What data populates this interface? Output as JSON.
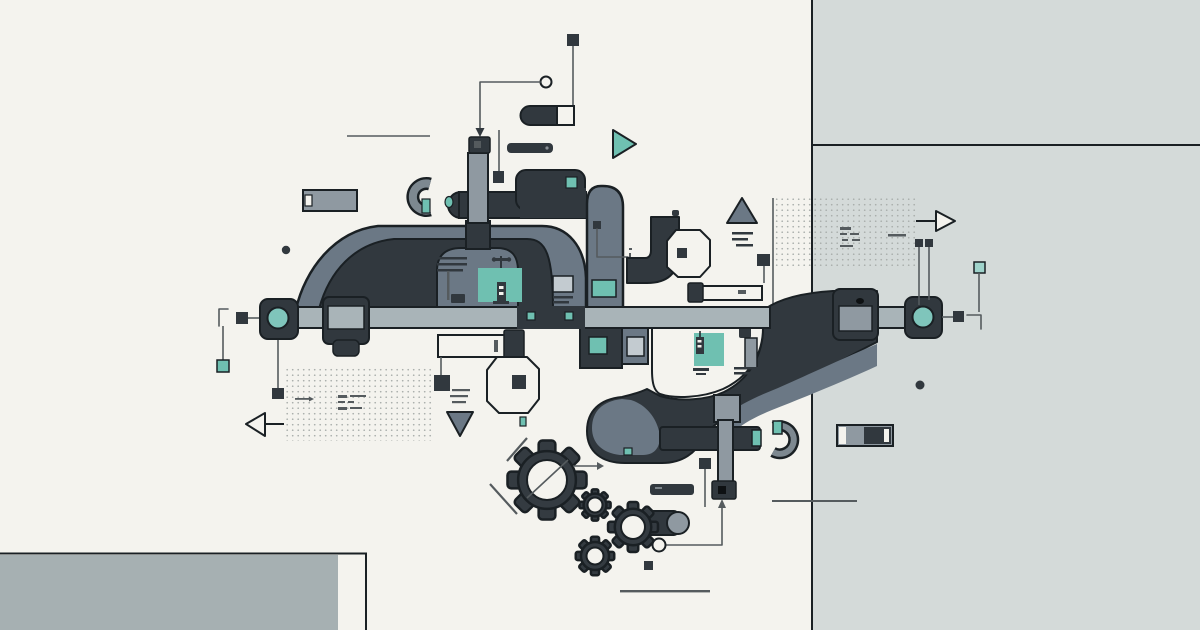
{
  "figure": {
    "type": "abstract-illustration",
    "title": "Abstract machinery illustration",
    "alt": "Flat vector artwork of two interlocking dark duct arches joined by a horizontal rail with teal hub joints, surrounded by gears, small pipes, capsules, triangles, dotted grids and circuit-like glyph marks on an off-white and gray-blue split background"
  },
  "palette": {
    "paper": "#f4f3ee",
    "panel": "#d4dad9",
    "bottom_panel": "#a6b0b2",
    "dark": "#31383e",
    "outline": "#1a2024",
    "grayblue": "#6b7885",
    "pipe": "#8f99a1",
    "bar": "#a9b4b8",
    "light": "#c3cbd0",
    "teal": "#6fc0b1",
    "teal_light": "#9fd3cb",
    "teal_hub": "#7fc5bb",
    "ink": "#555b5e",
    "dot": "#a9aeab"
  },
  "elements": {
    "background": "off-white field with gray-blue right panel and bottom-left slab",
    "rail": "horizontal gray rail with teal-hub joints at both ends",
    "upper_arch": "dark duct arch left of center above the rail",
    "lower_arch": "dark duct swoosh right of center below the rail",
    "gear_cluster": "four dark gears at bottom center",
    "glyphs": "triangles, octagons, capsules, dotted grids, micro circuit marks"
  }
}
